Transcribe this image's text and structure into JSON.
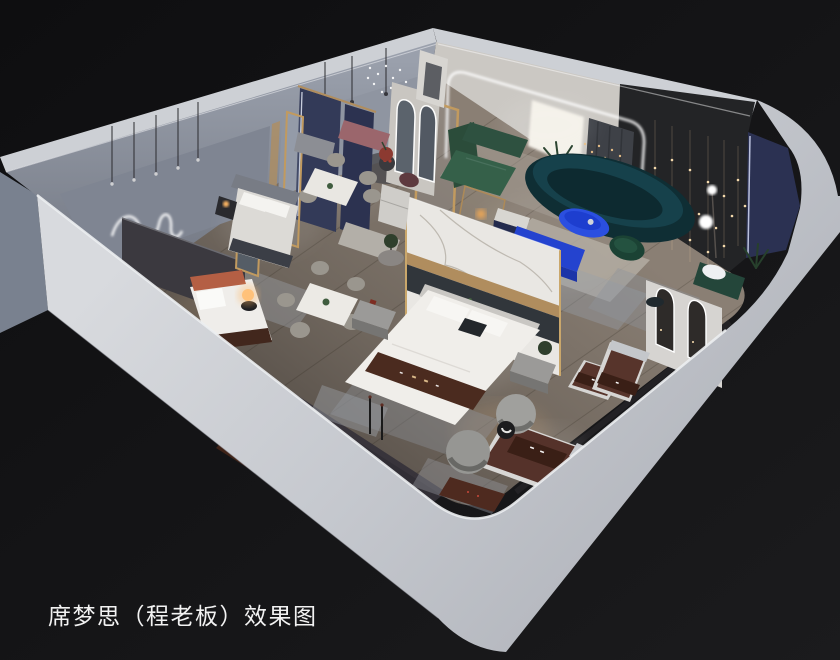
{
  "caption": {
    "text": "席梦思（程老板）效果图"
  },
  "scene": {
    "type": "3d-interior-rendering",
    "subject": "mattress-showroom-isometric-cutaway",
    "colors": {
      "background": "#131315",
      "wall_outer_bright": "#cdd0d5",
      "wall_band_light": "#d7d9dd",
      "wall_band_dark": "#b4b7be",
      "wall_top_edge": "#eceef1",
      "nw_wall_top": "#9aa0ac",
      "nw_wall_bottom": "#6e737e",
      "nw_outer_face": "#79818f",
      "floor_light": "#867b70",
      "floor_dark": "#4f4842",
      "arch_wall": "#cbc8c3",
      "lightbox": "#f4f1e9",
      "curtain": "#3e4147",
      "dark_display_panel": "#232426",
      "navy_panel": "#2b3152",
      "navy_drape": "#333a58",
      "led_white": "#ffffff",
      "gold_trim": "#b08d5e",
      "string_light_gold": "#e9c089",
      "marble": "#e9e7e3",
      "marble_vein": "#b7b2a9",
      "mirror_strip": "#31363b",
      "teal_sofa": "#0f2e34",
      "teal_sofa_top": "#16414b",
      "cobalt_table": "#2b4fe0",
      "cobalt_console": "#2443cf",
      "green_sectional": "#2e5140",
      "green_chair": "#1b4234",
      "green_bench": "#24463a",
      "rose_bench": "#9b666c",
      "red_side_table": "#8c3a31",
      "mattress_brown": "#57342b",
      "brand_band_brown": "#3a1f16",
      "bed_runner_brown": "#4b2b1f",
      "orange_headboard": "#b45f44",
      "bed_white": "#f0eeea",
      "duvet_gray": "#dcdad6",
      "rug_gray": "#9096a0",
      "rug_cream": "#b5afa5",
      "chair_greige": "#9a968e",
      "stone_bench": "#b3afa8",
      "interior_shadow_face": "#343138",
      "warm_glow": "#ffc786",
      "caption_text": "#f2f2f2"
    }
  }
}
